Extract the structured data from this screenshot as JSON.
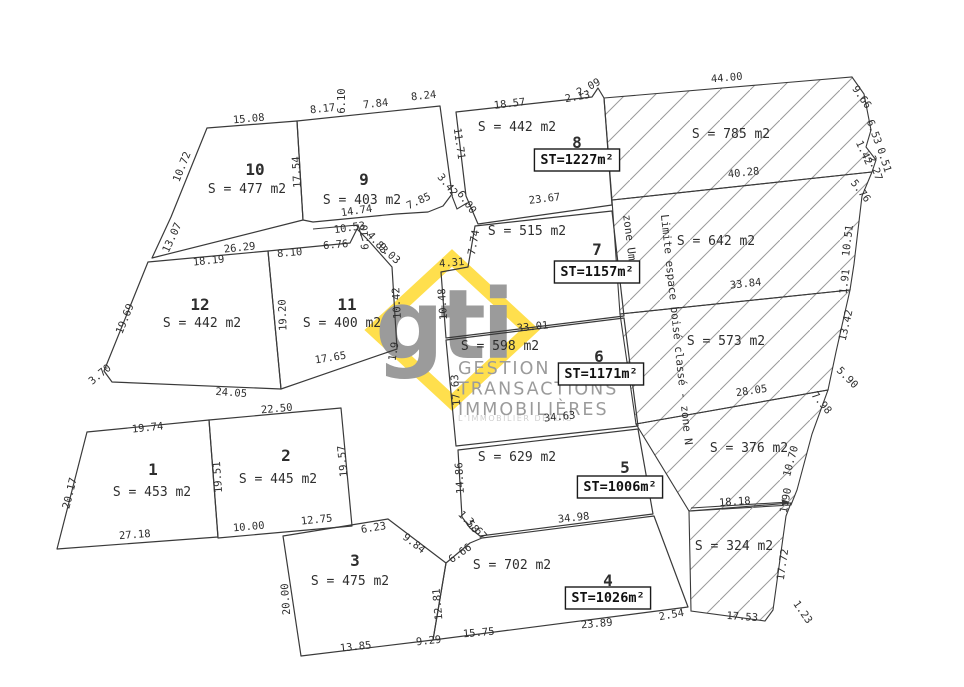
{
  "plan": {
    "palette": {
      "line": "#3a3a3a",
      "hatch": "#9a9a9a",
      "dim_text": "#2e2e2e",
      "box_stroke": "#1a1a1a",
      "logo_yellow": "#ffdf4d",
      "logo_gray": "#9b9b9b",
      "logo_light": "#cfcfcf",
      "background": "#ffffff"
    },
    "logo": {
      "mark": "gti",
      "lines": [
        "GESTION",
        "TRANSACTIONS",
        "IMMOBILIÈRES"
      ],
      "tagline": "L'IMMOBILIER DEPUIS"
    },
    "zone_labels": [
      {
        "text": "zone Um",
        "x": 626,
        "y": 238,
        "r": 83
      },
      {
        "text": "Limite espace boisé classé - zone N",
        "x": 673,
        "y": 330,
        "r": 84
      }
    ],
    "lots": [
      {
        "number": "10",
        "area": "S = 477 m2",
        "poly": [
          [
            207,
            128
          ],
          [
            297,
            121
          ],
          [
            303,
            220
          ],
          [
            152,
            258
          ],
          [
            171,
            217
          ]
        ],
        "num_pos": [
          255,
          170
        ],
        "area_pos": [
          247,
          189
        ]
      },
      {
        "number": "9",
        "area": "S = 403 m2",
        "poly": [
          [
            297,
            121
          ],
          [
            440,
            106
          ],
          [
            452,
            194
          ],
          [
            443,
            206
          ],
          [
            428,
            212
          ],
          [
            396,
            214
          ],
          [
            313,
            222
          ],
          [
            303,
            220
          ]
        ],
        "num_pos": [
          364,
          180
        ],
        "area_pos": [
          362,
          200
        ]
      },
      {
        "number": "12",
        "area": "S = 442 m2",
        "poly": [
          [
            148,
            262
          ],
          [
            268,
            251
          ],
          [
            281,
            389
          ],
          [
            112,
            382
          ],
          [
            104,
            371
          ]
        ],
        "num_pos": [
          200,
          305
        ],
        "area_pos": [
          202,
          323
        ]
      },
      {
        "number": "11",
        "area": "S = 400 m2",
        "poly": [
          [
            268,
            251
          ],
          [
            350,
            243
          ],
          [
            357,
            229
          ],
          [
            368,
            240
          ],
          [
            392,
            267
          ],
          [
            397,
            349
          ],
          [
            281,
            389
          ]
        ],
        "num_pos": [
          347,
          305
        ],
        "area_pos": [
          342,
          323
        ]
      },
      {
        "number": "8",
        "area": "S = 442 m2",
        "st": "ST=1227m²",
        "poly": [
          [
            456,
            112
          ],
          [
            592,
            97
          ],
          [
            598,
            88
          ],
          [
            604,
            98
          ],
          [
            612,
            205
          ],
          [
            478,
            224
          ],
          [
            466,
            196
          ]
        ],
        "num_pos": [
          577,
          143
        ],
        "area_pos": [
          517,
          127
        ],
        "st_pos": [
          577,
          160
        ]
      },
      {
        "number": "7",
        "area": "S = 515 m2",
        "st": "ST=1157m²",
        "poly": [
          [
            475,
            226
          ],
          [
            612,
            211
          ],
          [
            624,
            316
          ],
          [
            446,
            338
          ],
          [
            441,
            272
          ],
          [
            468,
            267
          ]
        ],
        "num_pos": [
          597,
          250
        ],
        "area_pos": [
          527,
          231
        ],
        "st_pos": [
          597,
          272
        ]
      },
      {
        "number": "6",
        "area": "S = 598 m2",
        "st": "ST=1171m²",
        "poly": [
          [
            446,
            340
          ],
          [
            624,
            318
          ],
          [
            638,
            426
          ],
          [
            456,
            446
          ]
        ],
        "num_pos": [
          599,
          357
        ],
        "area_pos": [
          500,
          346
        ],
        "st_pos": [
          601,
          374
        ]
      },
      {
        "number": "5",
        "area": "S = 629 m2",
        "st": "ST=1006m²",
        "poly": [
          [
            458,
            450
          ],
          [
            638,
            429
          ],
          [
            653,
            514
          ],
          [
            480,
            536
          ],
          [
            470,
            528
          ],
          [
            462,
            517
          ]
        ],
        "num_pos": [
          625,
          468
        ],
        "area_pos": [
          517,
          457
        ],
        "st_pos": [
          620,
          487
        ]
      },
      {
        "number": "4",
        "area": "S = 702 m2",
        "st": "ST=1026m²",
        "poly": [
          [
            482,
            538
          ],
          [
            654,
            516
          ],
          [
            688,
            607
          ],
          [
            433,
            640
          ],
          [
            446,
            563
          ],
          [
            470,
            543
          ]
        ],
        "num_pos": [
          608,
          581
        ],
        "area_pos": [
          512,
          565
        ],
        "st_pos": [
          608,
          598
        ]
      },
      {
        "number": "3",
        "area": "S = 475 m2",
        "poly": [
          [
            283,
            536
          ],
          [
            388,
            519
          ],
          [
            446,
            563
          ],
          [
            433,
            640
          ],
          [
            301,
            656
          ]
        ],
        "num_pos": [
          355,
          561
        ],
        "area_pos": [
          350,
          581
        ]
      },
      {
        "number": "2",
        "area": "S = 445 m2",
        "poly": [
          [
            209,
            420
          ],
          [
            341,
            408
          ],
          [
            352,
            526
          ],
          [
            218,
            538
          ]
        ],
        "num_pos": [
          286,
          456
        ],
        "area_pos": [
          278,
          479
        ]
      },
      {
        "number": "1",
        "area": "S = 453 m2",
        "poly": [
          [
            87,
            432
          ],
          [
            209,
            420
          ],
          [
            218,
            537
          ],
          [
            57,
            549
          ]
        ],
        "num_pos": [
          153,
          470
        ],
        "area_pos": [
          152,
          492
        ]
      }
    ],
    "hatched_zones": [
      {
        "label": "S = 785 m2",
        "poly": [
          [
            604,
            98
          ],
          [
            852,
            77
          ],
          [
            864,
            94
          ],
          [
            871,
            130
          ],
          [
            866,
            147
          ],
          [
            876,
            160
          ],
          [
            872,
            172
          ],
          [
            612,
            200
          ]
        ],
        "label_pos": [
          731,
          134
        ]
      },
      {
        "label": "S = 642 m2",
        "poly": [
          [
            612,
            200
          ],
          [
            872,
            172
          ],
          [
            862,
            196
          ],
          [
            854,
            264
          ],
          [
            850,
            290
          ],
          [
            620,
            314
          ]
        ],
        "label_pos": [
          716,
          241
        ]
      },
      {
        "label": "S = 573 m2",
        "poly": [
          [
            620,
            314
          ],
          [
            850,
            290
          ],
          [
            836,
            352
          ],
          [
            828,
            390
          ],
          [
            636,
            424
          ]
        ],
        "label_pos": [
          726,
          341
        ]
      },
      {
        "label": "S = 376 m2",
        "poly": [
          [
            636,
            424
          ],
          [
            828,
            390
          ],
          [
            812,
            434
          ],
          [
            797,
            490
          ],
          [
            791,
            505
          ],
          [
            689,
            511
          ]
        ],
        "label_pos": [
          749,
          448
        ]
      },
      {
        "label": "S = 324 m2",
        "poly": [
          [
            689,
            511
          ],
          [
            791,
            503
          ],
          [
            786,
            516
          ],
          [
            773,
            610
          ],
          [
            765,
            621
          ],
          [
            691,
            611
          ]
        ],
        "label_pos": [
          734,
          546
        ]
      }
    ],
    "extra_lines": [
      {
        "pts": [
          [
            313,
            229
          ],
          [
            358,
            225
          ],
          [
            363,
            241
          ]
        ],
        "arrow": false
      },
      {
        "pts": [
          [
            452,
            196
          ],
          [
            457,
            209
          ],
          [
            467,
            203
          ]
        ],
        "arrow": false
      },
      {
        "pts": [
          [
            691,
            508
          ],
          [
            789,
            502
          ]
        ],
        "arrow": true
      }
    ],
    "dimensions": [
      {
        "t": "15.08",
        "x": 249,
        "y": 122,
        "r": -5
      },
      {
        "t": "10.72",
        "x": 185,
        "y": 168,
        "r": -68
      },
      {
        "t": "13.07",
        "x": 175,
        "y": 239,
        "r": -65
      },
      {
        "t": "17.54",
        "x": 300,
        "y": 172,
        "r": -93
      },
      {
        "t": "8.17",
        "x": 323,
        "y": 112,
        "r": -6
      },
      {
        "t": "6.10",
        "x": 345,
        "y": 101,
        "r": -90
      },
      {
        "t": "7.84",
        "x": 376,
        "y": 107,
        "r": -6
      },
      {
        "t": "8.24",
        "x": 424,
        "y": 99,
        "r": -6
      },
      {
        "t": "11.71",
        "x": 456,
        "y": 144,
        "r": 82
      },
      {
        "t": "3.42",
        "x": 445,
        "y": 187,
        "r": 50
      },
      {
        "t": "7.85",
        "x": 420,
        "y": 204,
        "r": -25
      },
      {
        "t": "6.00",
        "x": 464,
        "y": 204,
        "r": 55
      },
      {
        "t": "14.74",
        "x": 357,
        "y": 214,
        "r": -8
      },
      {
        "t": "10.53",
        "x": 350,
        "y": 231,
        "r": -8
      },
      {
        "t": "6.10",
        "x": 368,
        "y": 237,
        "r": -93
      },
      {
        "t": "4.83",
        "x": 375,
        "y": 245,
        "r": 48
      },
      {
        "t": "9.03",
        "x": 387,
        "y": 256,
        "r": 42
      },
      {
        "t": "26.29",
        "x": 240,
        "y": 251,
        "r": -6
      },
      {
        "t": "18.19",
        "x": 209,
        "y": 264,
        "r": -6
      },
      {
        "t": "8.10",
        "x": 290,
        "y": 256,
        "r": -5
      },
      {
        "t": "6.76",
        "x": 336,
        "y": 248,
        "r": -5
      },
      {
        "t": "19.69",
        "x": 128,
        "y": 320,
        "r": -68
      },
      {
        "t": "3.70",
        "x": 102,
        "y": 377,
        "r": -40
      },
      {
        "t": "24.05",
        "x": 231,
        "y": 396,
        "r": 4
      },
      {
        "t": "19.20",
        "x": 286,
        "y": 315,
        "r": -92
      },
      {
        "t": "17.65",
        "x": 331,
        "y": 361,
        "r": -9
      },
      {
        "t": "10.42",
        "x": 400,
        "y": 303,
        "r": -93
      },
      {
        "t": "1.9",
        "x": 397,
        "y": 352,
        "r": -80
      },
      {
        "t": "18.57",
        "x": 510,
        "y": 107,
        "r": -7
      },
      {
        "t": "2.13",
        "x": 578,
        "y": 100,
        "r": -10
      },
      {
        "t": "2.09",
        "x": 590,
        "y": 90,
        "r": -28
      },
      {
        "t": "23.67",
        "x": 545,
        "y": 202,
        "r": -7
      },
      {
        "t": "7.74",
        "x": 477,
        "y": 243,
        "r": -80
      },
      {
        "t": "4.31",
        "x": 452,
        "y": 266,
        "r": -5
      },
      {
        "t": "10.48",
        "x": 446,
        "y": 304,
        "r": -94
      },
      {
        "t": "33.01",
        "x": 533,
        "y": 330,
        "r": -6
      },
      {
        "t": "17.63",
        "x": 459,
        "y": 390,
        "r": -94
      },
      {
        "t": "34.63",
        "x": 560,
        "y": 420,
        "r": -6
      },
      {
        "t": "14.86",
        "x": 463,
        "y": 478,
        "r": -93
      },
      {
        "t": "34.98",
        "x": 574,
        "y": 521,
        "r": -6
      },
      {
        "t": "1.58",
        "x": 466,
        "y": 524,
        "r": 48
      },
      {
        "t": "3.67",
        "x": 474,
        "y": 531,
        "r": 48
      },
      {
        "t": "6.66",
        "x": 462,
        "y": 556,
        "r": -35
      },
      {
        "t": "12.81",
        "x": 441,
        "y": 604,
        "r": -95
      },
      {
        "t": "15.75",
        "x": 479,
        "y": 636,
        "r": -5
      },
      {
        "t": "23.89",
        "x": 597,
        "y": 627,
        "r": -5
      },
      {
        "t": "2.54",
        "x": 672,
        "y": 618,
        "r": -10
      },
      {
        "t": "9.84",
        "x": 412,
        "y": 546,
        "r": 38
      },
      {
        "t": "6.23",
        "x": 374,
        "y": 531,
        "r": -9
      },
      {
        "t": "20.00",
        "x": 289,
        "y": 599,
        "r": -94
      },
      {
        "t": "13.85",
        "x": 356,
        "y": 650,
        "r": -6
      },
      {
        "t": "9.29",
        "x": 429,
        "y": 644,
        "r": -6
      },
      {
        "t": "19.74",
        "x": 148,
        "y": 431,
        "r": -6
      },
      {
        "t": "22.50",
        "x": 277,
        "y": 412,
        "r": -5
      },
      {
        "t": "20.17",
        "x": 73,
        "y": 494,
        "r": -76
      },
      {
        "t": "19.51",
        "x": 221,
        "y": 477,
        "r": -94
      },
      {
        "t": "19.57",
        "x": 346,
        "y": 461,
        "r": -95
      },
      {
        "t": "27.18",
        "x": 135,
        "y": 538,
        "r": -4
      },
      {
        "t": "10.00",
        "x": 249,
        "y": 530,
        "r": -5
      },
      {
        "t": "12.75",
        "x": 317,
        "y": 523,
        "r": -6
      },
      {
        "t": "44.00",
        "x": 727,
        "y": 81,
        "r": -5
      },
      {
        "t": "9.66",
        "x": 859,
        "y": 99,
        "r": 55
      },
      {
        "t": "6.53",
        "x": 871,
        "y": 133,
        "r": 70
      },
      {
        "t": "1.42",
        "x": 861,
        "y": 154,
        "r": 65
      },
      {
        "t": "2.27",
        "x": 872,
        "y": 169,
        "r": 72
      },
      {
        "t": "0.51",
        "x": 881,
        "y": 161,
        "r": 72
      },
      {
        "t": "40.28",
        "x": 744,
        "y": 176,
        "r": -6
      },
      {
        "t": "5.76",
        "x": 858,
        "y": 193,
        "r": 52
      },
      {
        "t": "10.51",
        "x": 851,
        "y": 241,
        "r": -83
      },
      {
        "t": "1.91",
        "x": 848,
        "y": 282,
        "r": -83
      },
      {
        "t": "33.84",
        "x": 746,
        "y": 287,
        "r": -6
      },
      {
        "t": "13.42",
        "x": 849,
        "y": 326,
        "r": -77
      },
      {
        "t": "5.90",
        "x": 845,
        "y": 380,
        "r": 45
      },
      {
        "t": "28.05",
        "x": 752,
        "y": 394,
        "r": -8
      },
      {
        "t": "7.98",
        "x": 819,
        "y": 405,
        "r": 50
      },
      {
        "t": "10.70",
        "x": 794,
        "y": 462,
        "r": -75
      },
      {
        "t": "1.90",
        "x": 789,
        "y": 501,
        "r": -80
      },
      {
        "t": "18.18",
        "x": 735,
        "y": 505,
        "r": -4
      },
      {
        "t": "17.72",
        "x": 786,
        "y": 565,
        "r": -82
      },
      {
        "t": "1.23",
        "x": 800,
        "y": 614,
        "r": 55
      },
      {
        "t": "17.53",
        "x": 742,
        "y": 620,
        "r": 4
      }
    ]
  }
}
